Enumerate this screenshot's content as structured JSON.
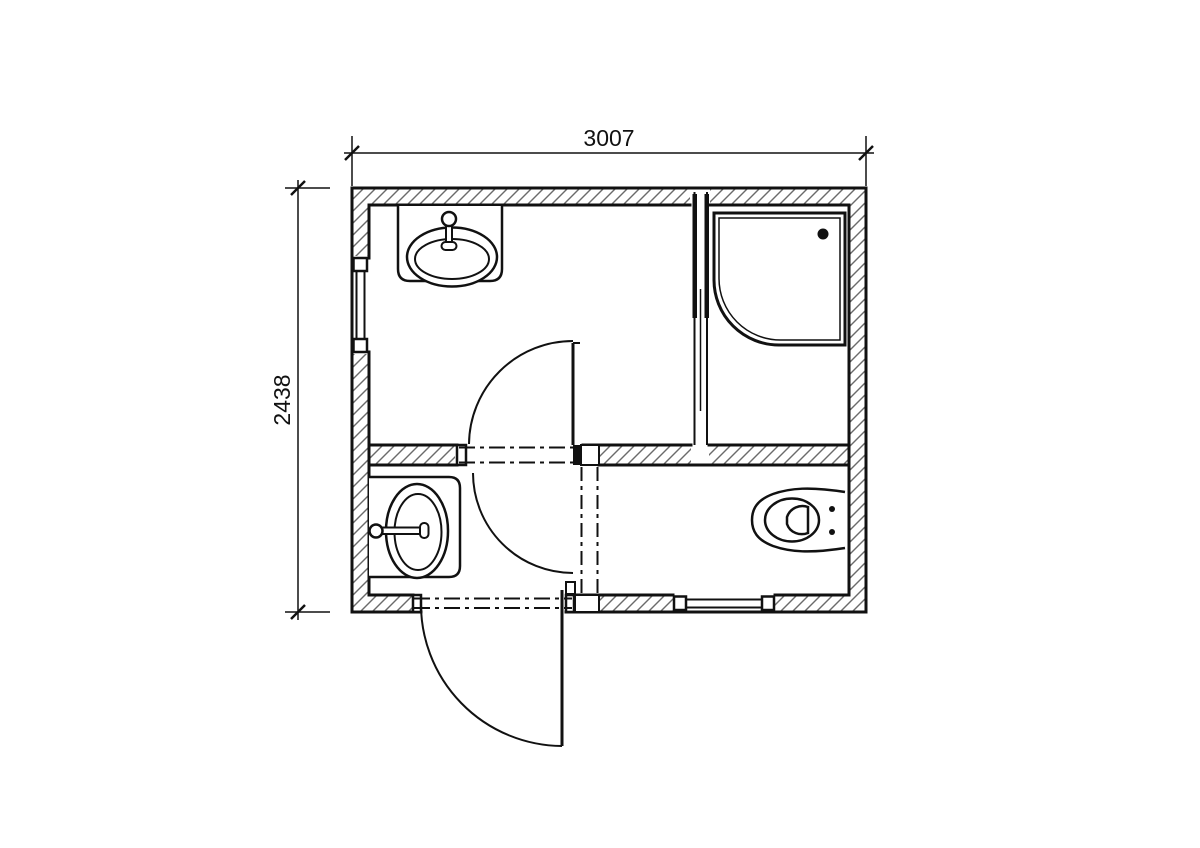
{
  "drawing": {
    "type": "architectural-floor-plan",
    "description": "Bathroom / sanitary module plan with two washbasins, corner shower, toilet, interior double-swing door, exterior door and two wall windows"
  },
  "dimensions": {
    "width": "3007",
    "height": "2438"
  },
  "colors": {
    "line": "#111111",
    "hatch": "#6b6b6b",
    "background": "#ffffff"
  },
  "fixtures": {
    "washbasin_top": "oval washbasin with faucet on top wall counter",
    "washbasin_bottom": "oval washbasin with faucet on left wall counter",
    "shower": "corner shower tray with drain",
    "toilet": "toilet against right wall",
    "interior_door": "double-swing door in partition wall",
    "exterior_door": "outward swing door in bottom wall",
    "window_left": "window in left wall",
    "window_bottom": "window in bottom wall",
    "room_divider": "dash-dot divider between lower rooms"
  }
}
